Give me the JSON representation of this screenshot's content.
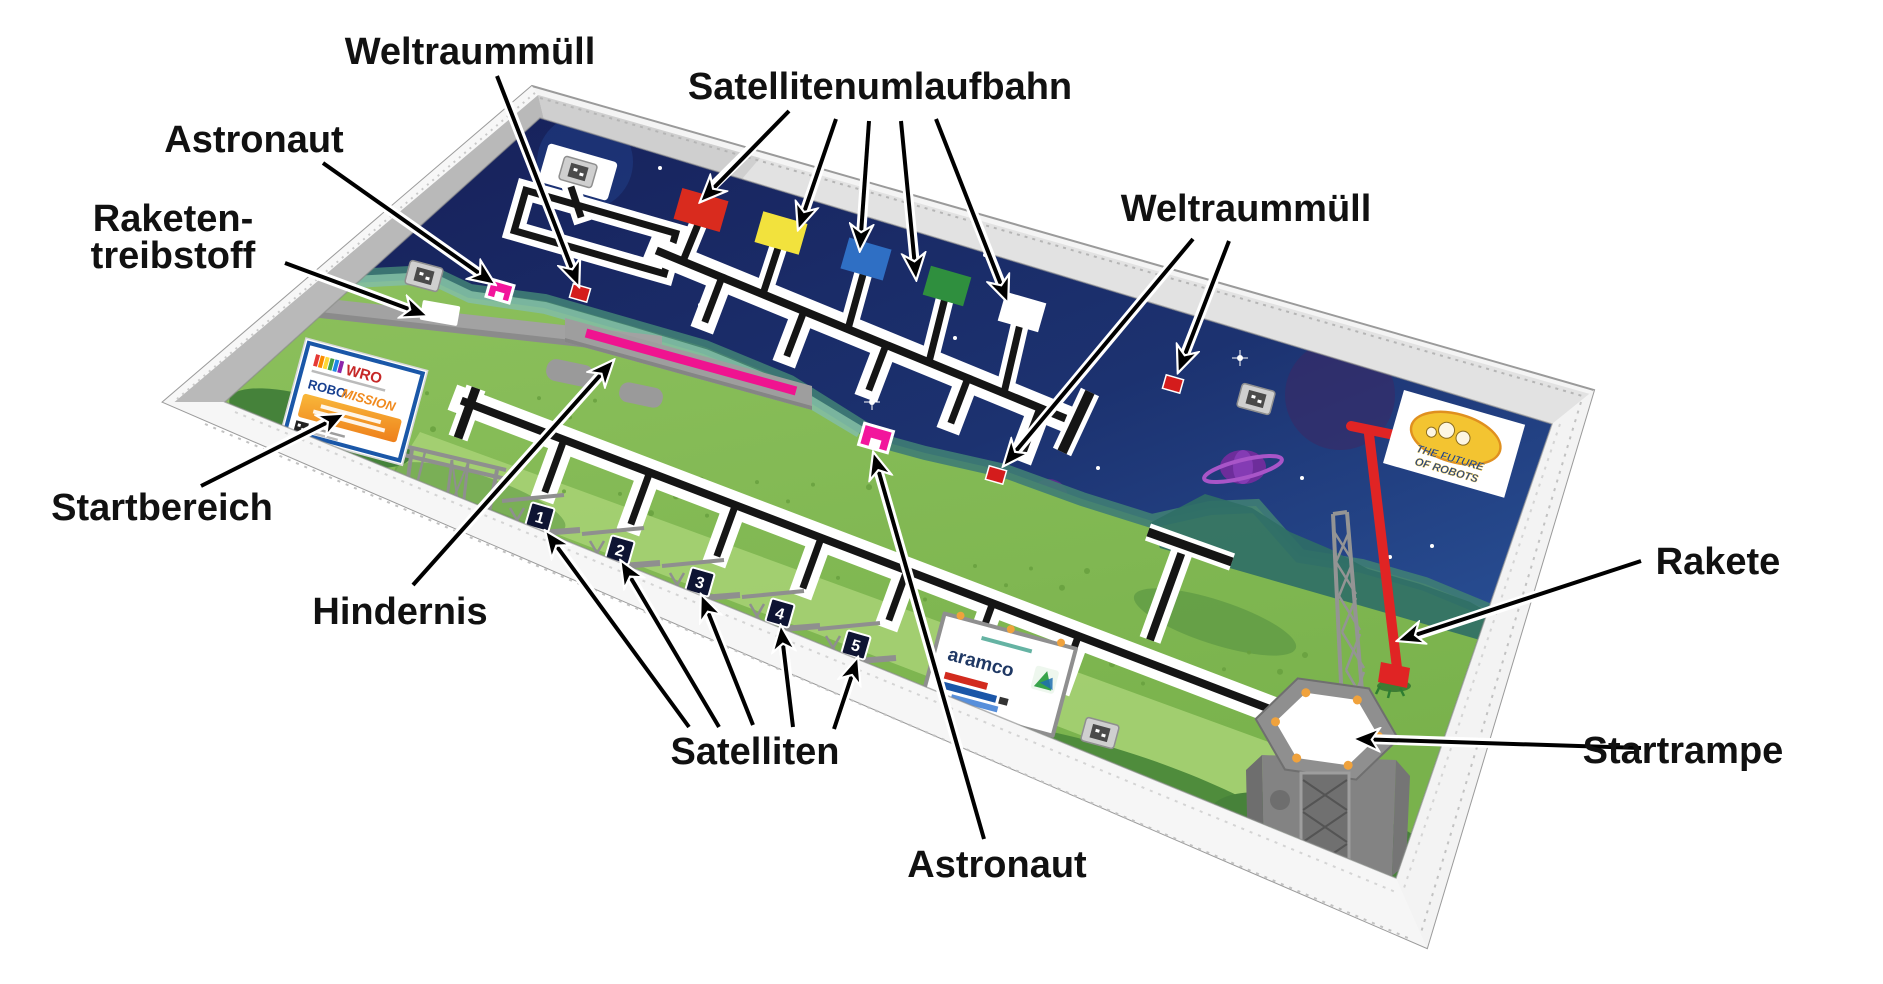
{
  "labels": {
    "weltraummuell_top": "Weltraummüll",
    "satellitenumlaufbahn": "Satellitenumlaufbahn",
    "astronaut_left": "Astronaut",
    "raketentreibstoff_line1": "Raketen-",
    "raketentreibstoff_line2": "treibstoff",
    "weltraummuell_right": "Weltraummüll",
    "startbereich": "Startbereich",
    "hindernis": "Hindernis",
    "satelliten": "Satelliten",
    "astronaut_bottom": "Astronaut",
    "rakete": "Rakete",
    "startrampe": "Startrampe"
  },
  "field": {
    "satellite_numbers": [
      "1",
      "2",
      "3",
      "4",
      "5"
    ],
    "orbit_square_colors": [
      "red",
      "yellow",
      "blue",
      "green",
      "white"
    ],
    "colors": {
      "satellite_red": "#d92b1e",
      "satellite_yellow": "#f2e23d",
      "satellite_blue": "#2f6fc4",
      "satellite_green": "#2f8f3e",
      "orbit_empty": "#ffffff",
      "space_debris": "#d41c1c",
      "astronaut": "#f2169c",
      "obstacle_stripe": "#ef1390",
      "rocket": "#e02424",
      "launchpad_light": "#f0a23c"
    },
    "logos": {
      "wro": {
        "name": "WRO",
        "robo": "ROBO",
        "mission": "MISSION"
      },
      "aramco": {
        "name": "aramco"
      },
      "future": {
        "line1": "THE FUTURE",
        "line2": "OF ROBOTS"
      }
    }
  }
}
